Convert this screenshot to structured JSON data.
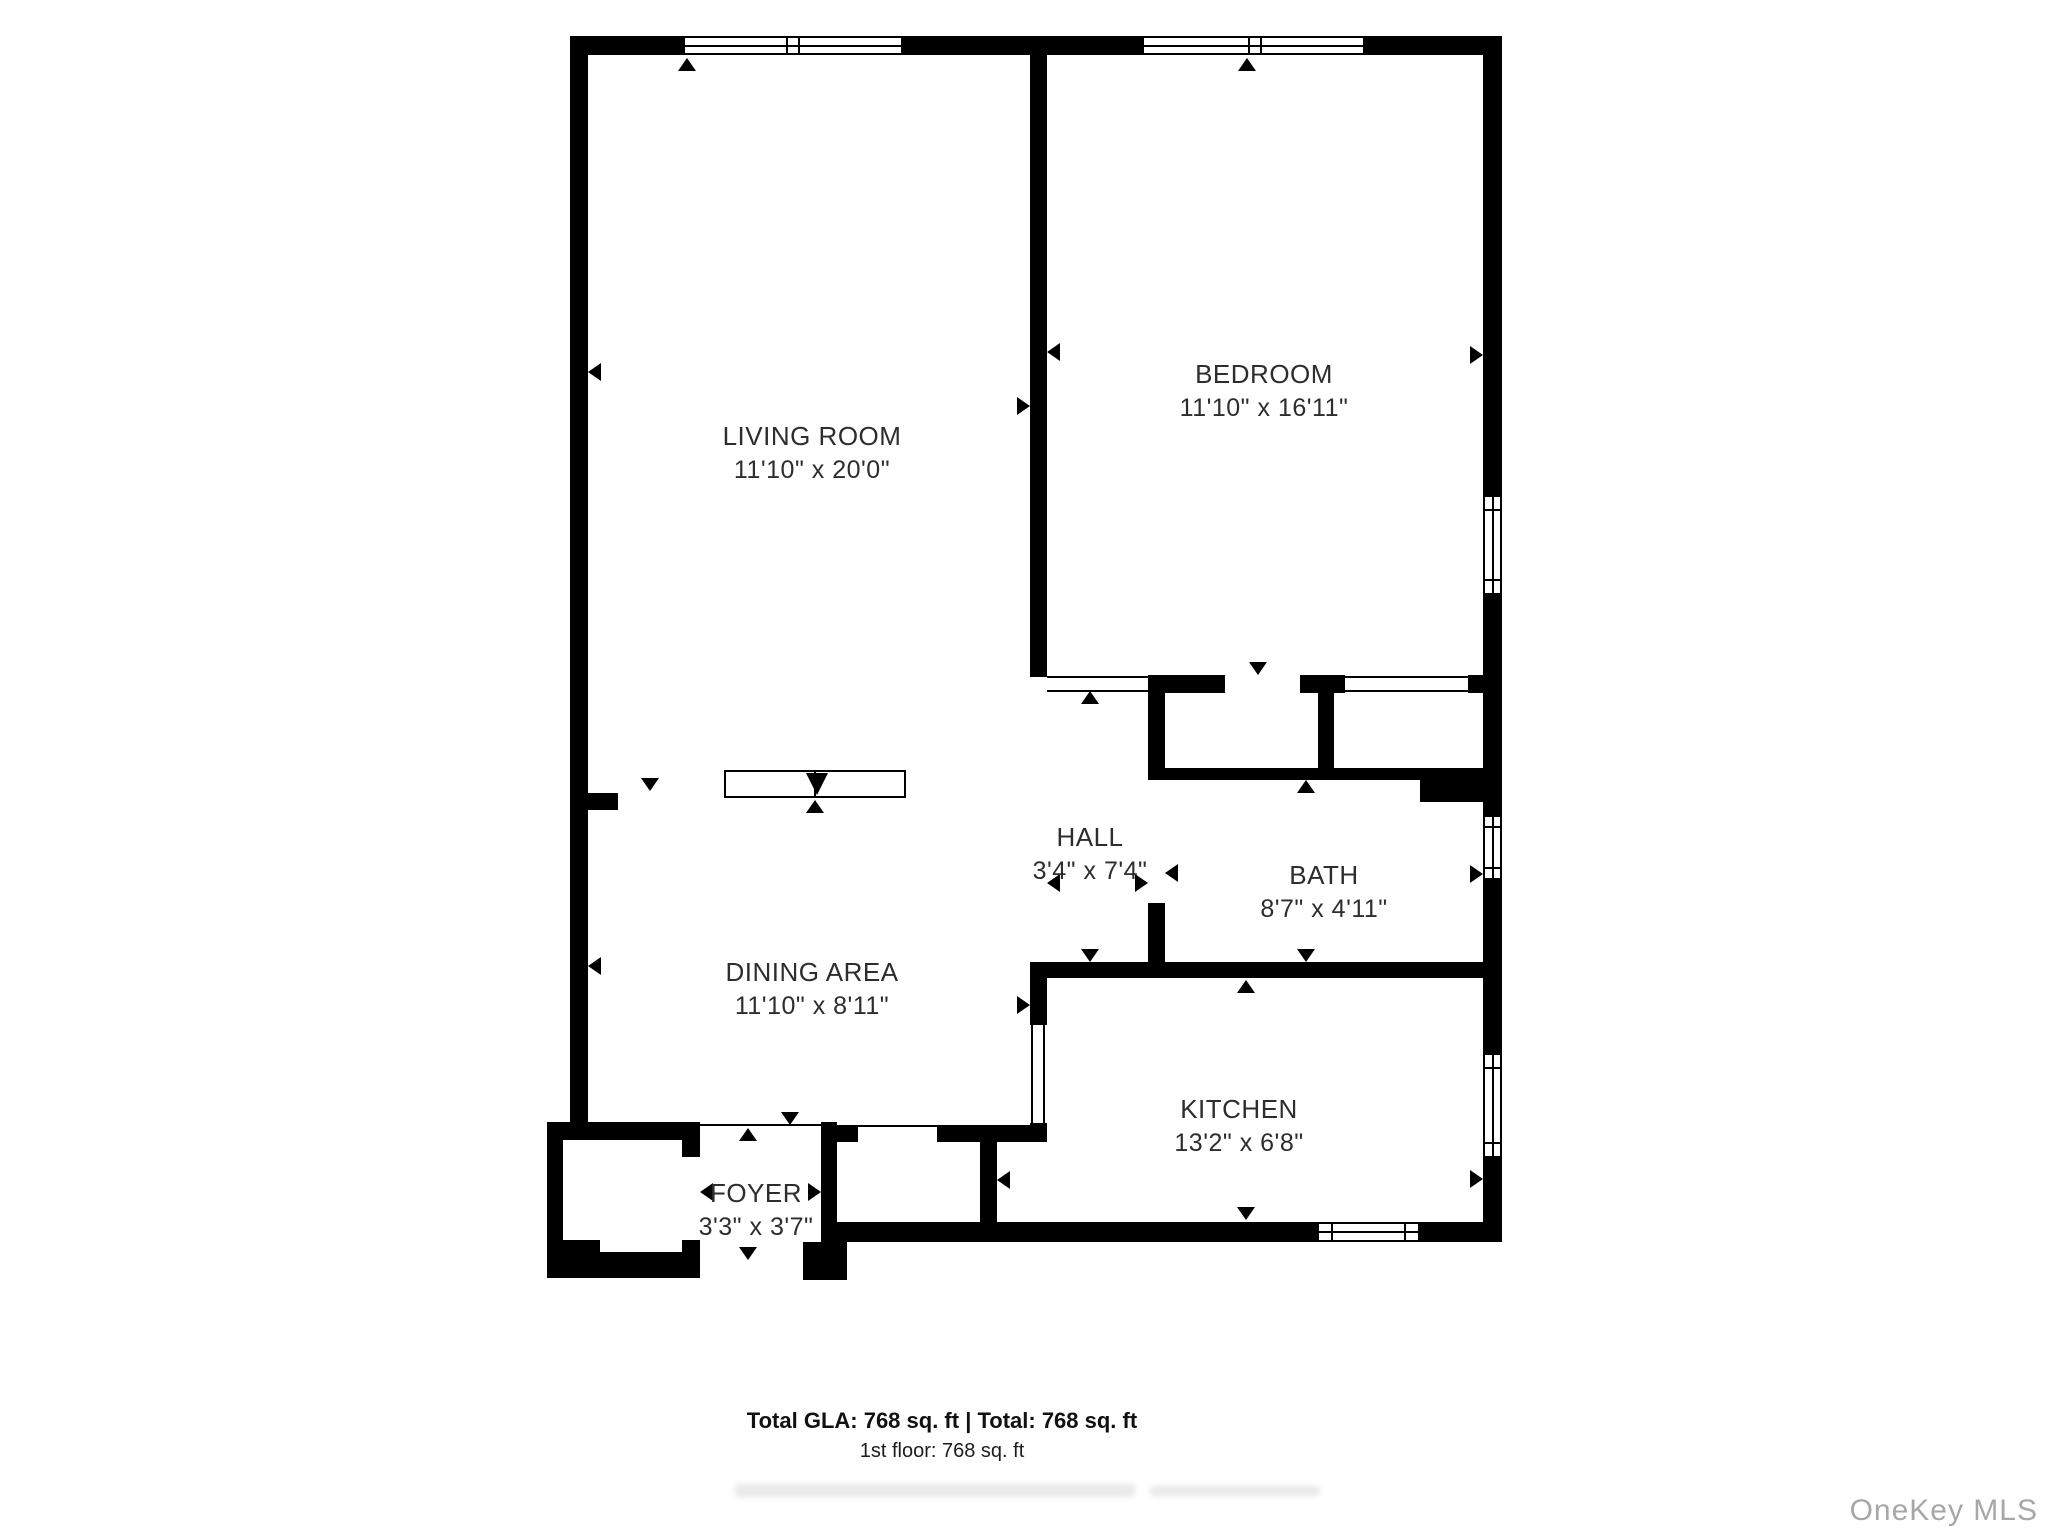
{
  "rooms": [
    {
      "name": "LIVING ROOM",
      "dims": "11'10\" x 20'0\""
    },
    {
      "name": "BEDROOM",
      "dims": "11'10\" x 16'11\""
    },
    {
      "name": "HALL",
      "dims": "3'4\" x 7'4\""
    },
    {
      "name": "BATH",
      "dims": "8'7\" x 4'11\""
    },
    {
      "name": "DINING AREA",
      "dims": "11'10\" x 8'11\""
    },
    {
      "name": "KITCHEN",
      "dims": "13'2\" x 6'8\""
    },
    {
      "name": "FOYER",
      "dims": "3'3\" x 3'7\""
    }
  ],
  "footer": {
    "total_line": "Total GLA: 768 sq. ft | Total: 768 sq. ft",
    "floor_line": "1st floor: 768 sq. ft"
  },
  "watermark": "OneKey MLS",
  "colors": {
    "wall": "#000000",
    "label_text": "#2d2d2d",
    "watermark": "#9e9e9e"
  }
}
